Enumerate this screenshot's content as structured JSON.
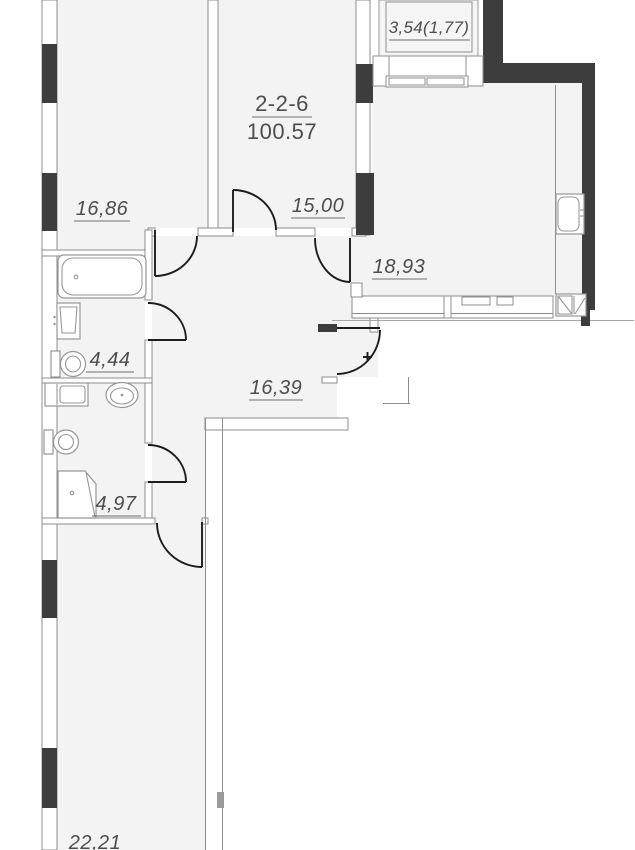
{
  "floor_plan": {
    "unit_code": "2-2-6",
    "total_area": "100.57",
    "areas": {
      "room_top_left": "16,86",
      "room_top_mid": "15,00",
      "balcony": "3,54(1,77)",
      "kitchen_living": "18,93",
      "bathroom_small": "4,44",
      "hallway": "16,39",
      "bathroom_large": "4,97",
      "room_bottom": "22,21"
    },
    "colors": {
      "bearing_wall": "#3d3d3d",
      "wall_line": "#8c8c8c",
      "room_fill": "#f3f3f3",
      "door_arc": "#1c1c1c",
      "label_text": "#4d4d4d"
    }
  }
}
